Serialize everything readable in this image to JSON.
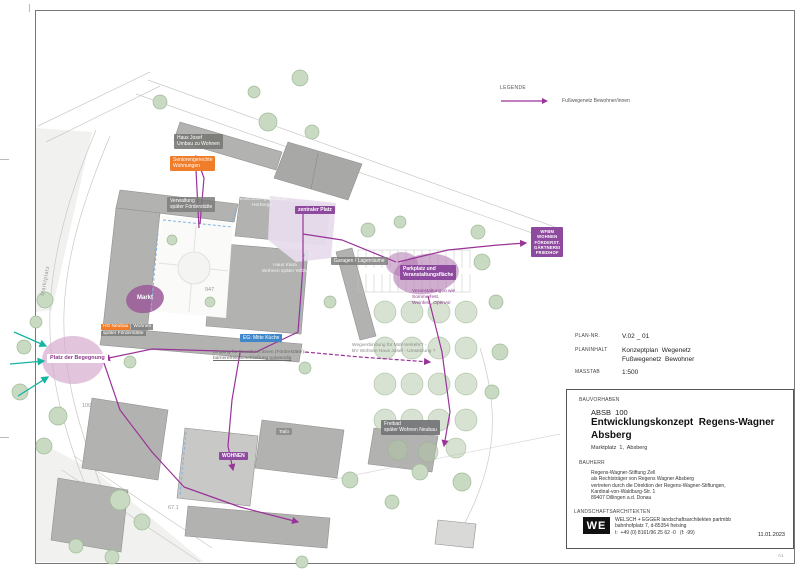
{
  "sheet": {
    "format_note": "A1",
    "date": "11.01.2023"
  },
  "legend": {
    "title": "LEGENDE",
    "item": "Fußwegenetz Bewohner/innen",
    "route_color": "#993399"
  },
  "titleblock": {
    "plan_nr_label": "PLAN-NR.",
    "plan_nr": "V.02 _ 01",
    "planinhalt_label": "PLANINHALT",
    "planinhalt1": "Konzeptplan  Wegenetz",
    "planinhalt2": "Fußwegenetz  Bewohner",
    "masstab_label": "MASSTAB",
    "masstab": "1:500",
    "bauvorhaben_label": "BAUVORHABEN",
    "code": "ABSB  100",
    "title1": "Entwicklungskonzept  Regens-Wagner",
    "title2": "Absberg",
    "address": "Marktplatz  1,  Absberg",
    "bauherr_label": "BAUHERR",
    "bauherr1": "Regens-Wagner-Stiftung Zell",
    "bauherr2": "als Rechtsträger von Regens Wagner Absberg",
    "bauherr3": "vertreten durch die Direktion der Regens-Wagner-Stiftungen,",
    "bauherr4": "Kardinal-von-Waldburg-Str. 1",
    "bauherr5": "89407 Dillingen a.d. Donau",
    "la_label": "LANDSCHAFTSARCHITEKTEN",
    "logo": "WE",
    "firm1": "WELSCH + EGGER landschaftsarchitekten partmbb",
    "firm2": "bahnhofplatz 7, d-85354 freising",
    "firm3": "t:  +49 (0) 8161/96 25 62 -0   (f: -99)",
    "date": "11.01.2023"
  },
  "map": {
    "street_name": "Marktplatz",
    "parcels": {
      "p1": "947",
      "p2": "100",
      "p3": "67.1"
    },
    "labels": {
      "haus_josef": {
        "line1": "Haus Josef",
        "line2": "Umbau zu Wohnen"
      },
      "senioren": {
        "line1": "Seniorengerechte",
        "line2": "Wohnungen"
      },
      "verwaltung": {
        "line1": "Verwaltung",
        "line2": "später Förderstätte"
      },
      "veranstaltung": {
        "line1": "Veranstaltungsgebäude",
        "line2": "Herberge"
      },
      "zentraler_platz": {
        "text": "zentraler Platz"
      },
      "haus_klara": {
        "line1": "Haus Klara",
        "line2": "Wohnen später WfbM"
      },
      "garagen": {
        "text": "Garagen / Lagerräume"
      },
      "parkplatz": {
        "line1": "Parkplatz und",
        "line2": "Veranstaltungsfläche",
        "note1": "Veranstaltungen wie",
        "note2": "Sommerfest,",
        "note3": "Weinfest, OpenAir"
      },
      "ziele": {
        "line1": "WFBM",
        "line2": "WOHNEN",
        "line3": "FÖRDERST.",
        "line4": "GÄRTNEREI",
        "line5": "FRIEDHOF"
      },
      "hg_neubau": {
        "chip": "HG Neubau",
        "line1": "Wohnen",
        "line2": "später Förderstätte"
      },
      "markt": {
        "text": "Markt"
      },
      "platz_der_begegnung": {
        "text": "Platz der Begegnung"
      },
      "kueche": {
        "text": "EG: Mitte Küche"
      },
      "eingang_note": {
        "line1": "Eingang für Bewohner:innen (Förderstätte):",
        "line2": "barrierefreie Erschließung notwendig"
      },
      "muell_note": {
        "line1": "Wegverbindung für Müll-Verkehr? -",
        "line2": "BV Wohnen Haus Josef - Umsetzung ?"
      },
      "wohnen": {
        "text": "WOHNEN"
      },
      "freibad": {
        "line1": "Freibad",
        "line2": "später Wohnen Neubau"
      },
      "trafo": {
        "text": "Trafo"
      }
    },
    "colors": {
      "route": "#993399",
      "accent_orange": "#ef7d2a",
      "accent_blue": "#3f87c8",
      "accent_purple": "#8d4a9e",
      "teal": "#17b3a3"
    }
  }
}
